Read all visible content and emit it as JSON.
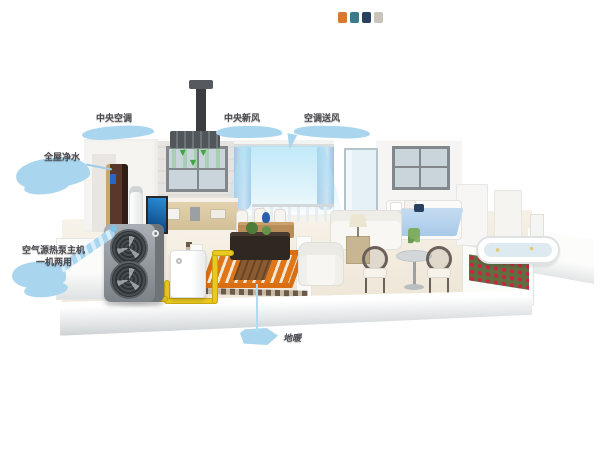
{
  "figure": {
    "type": "3d-home-cutaway-heat-pump-system",
    "background": "#ffffff"
  },
  "callouts": {
    "central_ac": {
      "label": "中央空调"
    },
    "fresh_air": {
      "label": "中央新风"
    },
    "ac_supply": {
      "label": "空调送风"
    },
    "water_purifier": {
      "label": "全屋净水"
    },
    "heat_pump_unit": {
      "line1": "空气源热泵主机",
      "line2": "一机两用"
    },
    "floor_heating": {
      "label": "地暖"
    }
  },
  "icons": {
    "down_arrow": "▼ ▼ ▼"
  },
  "colors": {
    "callout_bubble": "#a9d6ee",
    "callout_text": "#4a4a50",
    "pipe_yellow": "#e9c81f",
    "floor_heating_orange": "#e0761a",
    "fresh_air_green": "#3fa53f",
    "airflow_cyan": "#bfe7f4",
    "heat_pump_body": "#8e959b",
    "curtain_blue": "#a4c6e6",
    "bed_blanket_blue": "#b7d2ee",
    "flower_red": "#cc2244"
  }
}
